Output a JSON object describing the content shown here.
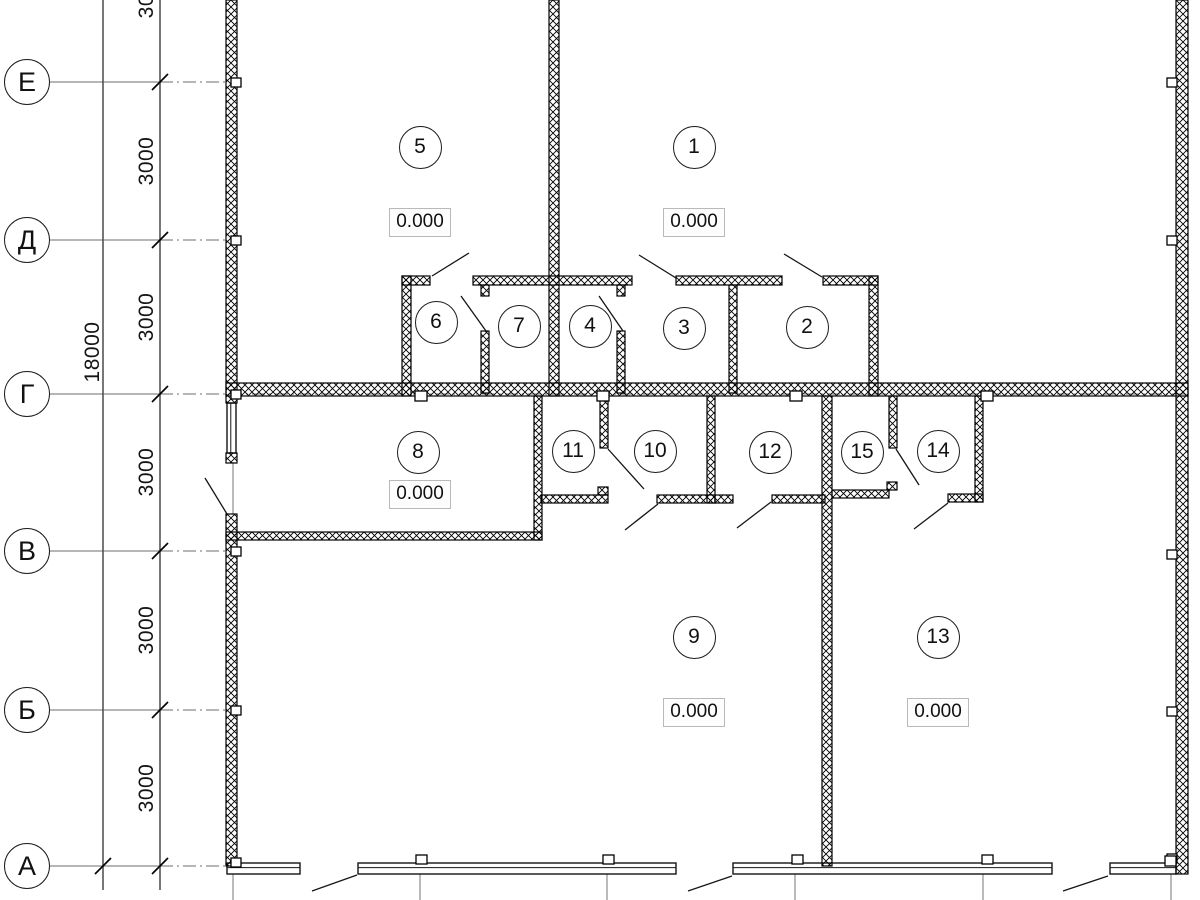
{
  "colors": {
    "wall_line": "#000000",
    "detail_line": "#141414",
    "axis_line": "#8a8a8a",
    "dim_line": "#4a4a4a",
    "gray_centerline": "#8c8c8c",
    "elevation_border": "#b9b9b9",
    "background": "#ffffff"
  },
  "axis_circles": [
    {
      "label": "Е",
      "y": 82,
      "dash_to": 226
    },
    {
      "label": "Д",
      "y": 240,
      "dash_to": 226
    },
    {
      "label": "Г",
      "y": 394,
      "dash_to": 1188
    },
    {
      "label": "В",
      "y": 551,
      "dash_to": 226
    },
    {
      "label": "Б",
      "y": 710,
      "dash_to": 226
    },
    {
      "label": "А",
      "y": 866,
      "dash_to": 233
    }
  ],
  "dimension_lines": {
    "total_x": 103,
    "interval_x": 160,
    "y_from": 0,
    "y_to": 890
  },
  "total_dimension": {
    "label": "18000",
    "cx": 93,
    "cy": 352
  },
  "interval_dimensions": [
    {
      "label": "3000",
      "cx": 147,
      "cy": -6
    },
    {
      "label": "3000",
      "cx": 147,
      "cy": 161
    },
    {
      "label": "3000",
      "cx": 147,
      "cy": 317
    },
    {
      "label": "3000",
      "cx": 147,
      "cy": 472
    },
    {
      "label": "3000",
      "cx": 147,
      "cy": 630
    },
    {
      "label": "3000",
      "cx": 147,
      "cy": 788
    }
  ],
  "ticks": [
    {
      "x": 160,
      "y": 82
    },
    {
      "x": 160,
      "y": 240
    },
    {
      "x": 160,
      "y": 394
    },
    {
      "x": 160,
      "y": 551
    },
    {
      "x": 160,
      "y": 710
    },
    {
      "x": 160,
      "y": 866
    },
    {
      "x": 103,
      "y": 866
    }
  ],
  "rooms": [
    {
      "number": "5",
      "cx": 420,
      "cy": 147
    },
    {
      "number": "1",
      "cx": 694,
      "cy": 147
    },
    {
      "number": "6",
      "cx": 436,
      "cy": 322
    },
    {
      "number": "7",
      "cx": 519,
      "cy": 326
    },
    {
      "number": "4",
      "cx": 590,
      "cy": 326
    },
    {
      "number": "3",
      "cx": 684,
      "cy": 328
    },
    {
      "number": "2",
      "cx": 807,
      "cy": 327
    },
    {
      "number": "8",
      "cx": 418,
      "cy": 452
    },
    {
      "number": "11",
      "cx": 573,
      "cy": 451
    },
    {
      "number": "10",
      "cx": 655,
      "cy": 451
    },
    {
      "number": "12",
      "cx": 770,
      "cy": 452
    },
    {
      "number": "15",
      "cx": 862,
      "cy": 452
    },
    {
      "number": "14",
      "cx": 938,
      "cy": 451
    },
    {
      "number": "9",
      "cx": 694,
      "cy": 637
    },
    {
      "number": "13",
      "cx": 938,
      "cy": 637
    }
  ],
  "elevations": [
    {
      "value": "0.000",
      "cx": 420,
      "cy": 222
    },
    {
      "value": "0.000",
      "cx": 694,
      "cy": 222
    },
    {
      "value": "0.000",
      "cx": 420,
      "cy": 494
    },
    {
      "value": "0.000",
      "cx": 694,
      "cy": 712
    },
    {
      "value": "0.000",
      "cx": 938,
      "cy": 712
    }
  ],
  "plan_geometry": {
    "walls": [
      [
        226,
        0,
        11,
        403
      ],
      [
        226,
        453,
        11,
        10
      ],
      [
        226,
        514,
        11,
        352
      ],
      [
        1176,
        0,
        12,
        874
      ],
      [
        549,
        0,
        10,
        396
      ],
      [
        226,
        383,
        962,
        13
      ],
      [
        402,
        276,
        9,
        120
      ],
      [
        402,
        276,
        28,
        9
      ],
      [
        473,
        276,
        159,
        9
      ],
      [
        676,
        276,
        106,
        9
      ],
      [
        823,
        276,
        55,
        9
      ],
      [
        869,
        276,
        9,
        120
      ],
      [
        481,
        285,
        8,
        11
      ],
      [
        481,
        331,
        8,
        62
      ],
      [
        617,
        285,
        8,
        11
      ],
      [
        617,
        331,
        8,
        62
      ],
      [
        729,
        285,
        8,
        108
      ],
      [
        534,
        396,
        8,
        144
      ],
      [
        226,
        532,
        316,
        8
      ],
      [
        600,
        396,
        8,
        52
      ],
      [
        541,
        495,
        67,
        8
      ],
      [
        598,
        487,
        10,
        8
      ],
      [
        657,
        495,
        58,
        8
      ],
      [
        707,
        396,
        8,
        107
      ],
      [
        715,
        495,
        18,
        8
      ],
      [
        772,
        495,
        53,
        8
      ],
      [
        822,
        396,
        10,
        470
      ],
      [
        889,
        396,
        8,
        52
      ],
      [
        832,
        490,
        57,
        8
      ],
      [
        887,
        482,
        10,
        8
      ],
      [
        948,
        494,
        35,
        8
      ],
      [
        975,
        396,
        8,
        106
      ]
    ],
    "windows": [
      [
        227,
        403,
        9,
        50
      ],
      [
        227,
        863,
        73,
        11
      ],
      [
        358,
        863,
        318,
        11
      ],
      [
        733,
        863,
        319,
        11
      ],
      [
        1110,
        863,
        66,
        11
      ]
    ],
    "door_swings": [
      [
        432,
        276,
        469,
        253
      ],
      [
        676,
        278,
        639,
        255
      ],
      [
        822,
        277,
        784,
        254
      ],
      [
        461,
        296,
        486,
        331
      ],
      [
        599,
        296,
        623,
        331
      ],
      [
        205,
        478,
        227,
        514
      ],
      [
        608,
        449,
        644,
        489
      ],
      [
        896,
        449,
        919,
        485
      ],
      [
        625,
        530,
        658,
        504
      ],
      [
        737,
        528,
        771,
        502
      ],
      [
        914,
        529,
        948,
        503
      ],
      [
        312,
        891,
        357,
        875
      ],
      [
        688,
        891,
        732,
        876
      ],
      [
        1063,
        891,
        1108,
        876
      ]
    ],
    "markers": [
      [
        231,
        78,
        10,
        9
      ],
      [
        231,
        236,
        10,
        9
      ],
      [
        231,
        390,
        10,
        9
      ],
      [
        231,
        547,
        10,
        9
      ],
      [
        231,
        706,
        10,
        9
      ],
      [
        231,
        858,
        10,
        9
      ],
      [
        1167,
        78,
        10,
        9
      ],
      [
        1167,
        236,
        10,
        9
      ],
      [
        1167,
        550,
        10,
        9
      ],
      [
        1167,
        707,
        10,
        9
      ],
      [
        1167,
        854,
        10,
        9
      ],
      [
        415,
        391,
        12,
        10
      ],
      [
        597,
        391,
        12,
        10
      ],
      [
        790,
        391,
        12,
        10
      ],
      [
        981,
        391,
        12,
        10
      ],
      [
        416,
        855,
        11,
        9
      ],
      [
        603,
        855,
        11,
        9
      ],
      [
        792,
        855,
        11,
        9
      ],
      [
        982,
        855,
        11,
        9
      ],
      [
        1165,
        856,
        11,
        10
      ]
    ],
    "gray_lines": [
      [
        233,
        874,
        233,
        900
      ],
      [
        420,
        874,
        420,
        900
      ],
      [
        607,
        874,
        607,
        900
      ],
      [
        795,
        874,
        795,
        900
      ],
      [
        983,
        874,
        983,
        900
      ],
      [
        1171,
        874,
        1171,
        900
      ],
      [
        233,
        462,
        233,
        514
      ]
    ]
  }
}
